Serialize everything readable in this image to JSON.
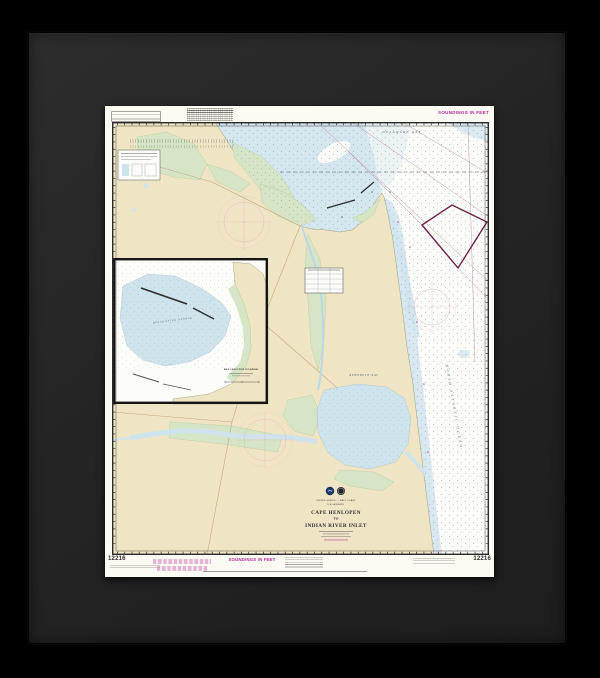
{
  "artwork": {
    "kind": "framed-nautical-chart",
    "frame_color": "#242424",
    "background_color": "#000000"
  },
  "chart": {
    "top_soundings": "SOUNDINGS IN FEET",
    "bottom": {
      "number_left": "12216",
      "number_right": "12216",
      "soundings": "SOUNDINGS IN FEET"
    },
    "map": {
      "labels": {
        "delaware_bay": "DELAWARE BAY",
        "rehoboth_bay": "REHOBOTH BAY",
        "north_atlantic_ocean": "NORTH ATLANTIC OCEAN"
      },
      "inset": {
        "water_label": "BREAKWATER HARBOR",
        "title": "BREAKWATER HARBOR"
      },
      "title_block": {
        "nation": "UNITED STATES — EAST COAST",
        "state": "DELAWARE",
        "line1": "CAPE HENLOPEN",
        "line2": "TO",
        "line3": "INDIAN RIVER INLET"
      }
    },
    "colors": {
      "land": "#efe4c4",
      "marsh": "#d5e5c5",
      "shallow_water": "#d3e4ec",
      "magenta": "#b5269e",
      "compass_rose": "#d793ab"
    }
  }
}
